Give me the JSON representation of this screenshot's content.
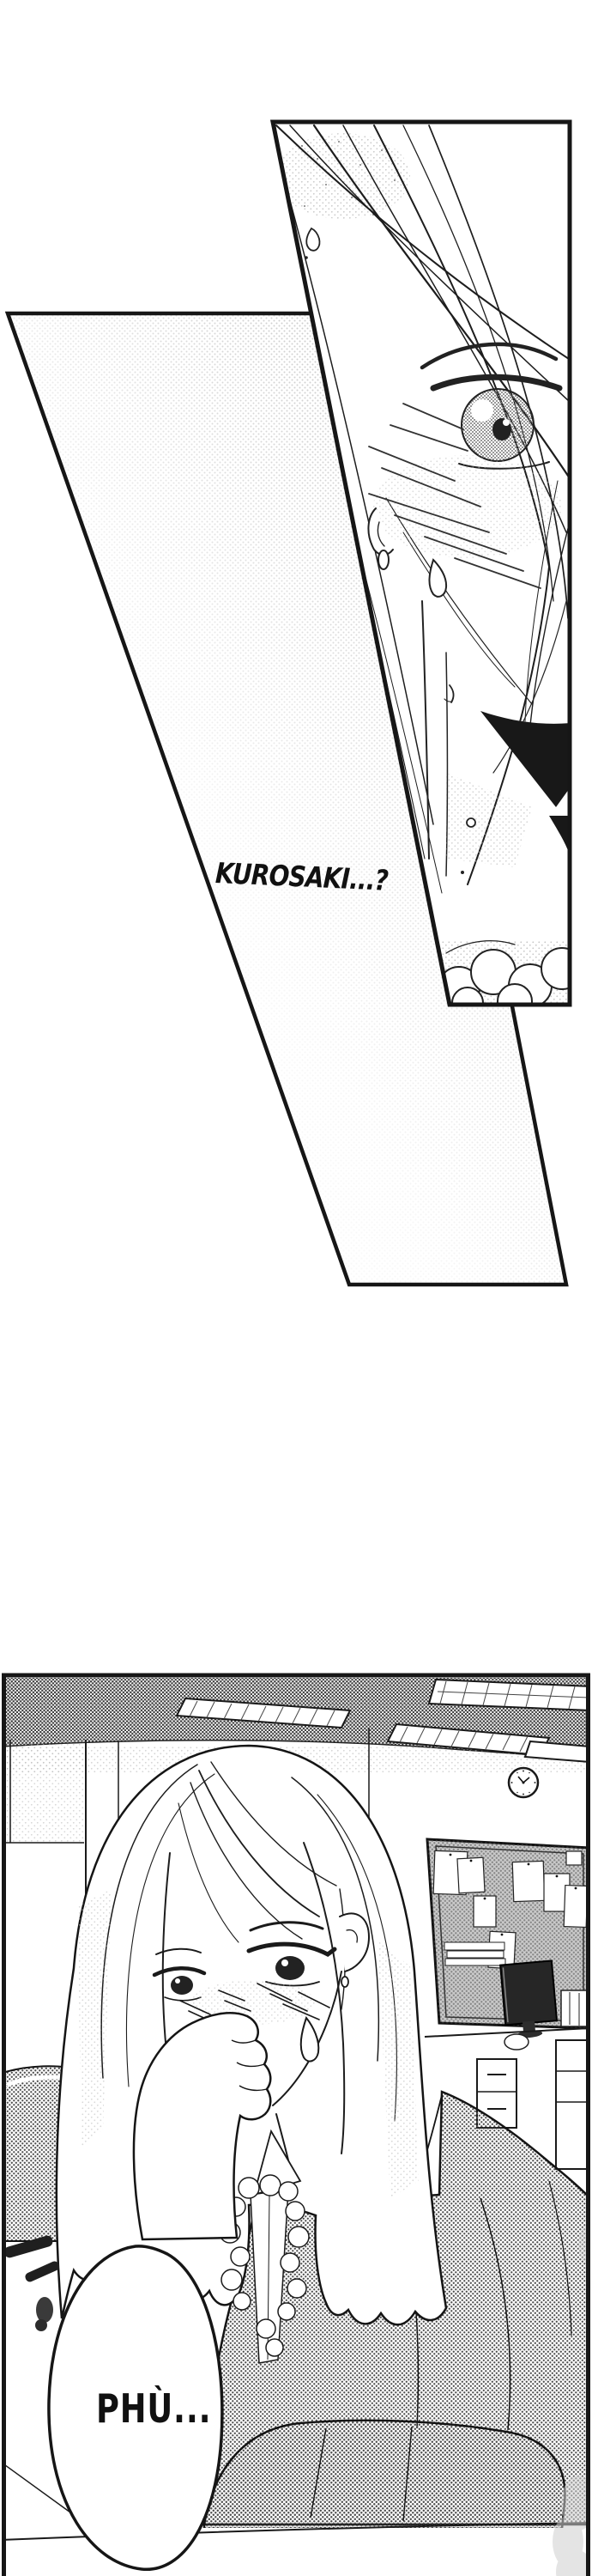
{
  "texts": {
    "flashback_dialogue": "KUROSAKI...?",
    "office_sigh": "PHÙ..."
  },
  "colors": {
    "paper": "#ffffff",
    "ink": "#1a1a1a",
    "tone_light": "#a6a6a6",
    "tone_mid": "#4f4f4f",
    "screen": "#262626"
  }
}
